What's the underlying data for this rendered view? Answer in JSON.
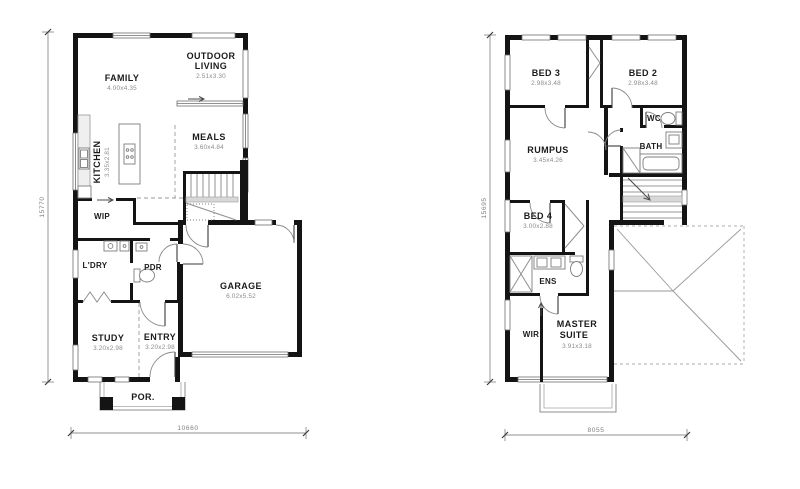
{
  "drawing": {
    "type": "residential floor plans, two storeys",
    "colors": {
      "wall": "#141414",
      "thin_line": "#8f8f8f",
      "room_text": "#1b1b1b",
      "size_text": "#8c8c8c",
      "dim_text": "#7f7f7f",
      "background": "#ffffff"
    }
  },
  "plans": {
    "ground": {
      "title": "ground-floor-plan",
      "dim_height": "15770",
      "dim_width": "10660",
      "rooms": {
        "family": {
          "name": "FAMILY",
          "size": "4.00x4.35"
        },
        "outdoor": {
          "line1": "OUTDOOR",
          "line2": "LIVING",
          "size": "2.51x3.30"
        },
        "kitchen": {
          "name": "KITCHEN",
          "size": "3.35x2.81"
        },
        "meals": {
          "name": "MEALS",
          "size": "3.60x4.84"
        },
        "wip": {
          "name": "WIP"
        },
        "ldry": {
          "name": "L'DRY"
        },
        "pdr": {
          "name": "PDR"
        },
        "study": {
          "name": "STUDY",
          "size": "3.20x2.98"
        },
        "entry": {
          "name": "ENTRY",
          "size": "3.20x2.98"
        },
        "garage": {
          "name": "GARAGE",
          "size": "6.02x5.52"
        },
        "porch": {
          "name": "POR."
        }
      }
    },
    "upper": {
      "title": "upper-floor-plan",
      "dim_height": "15695",
      "dim_width": "8055",
      "rooms": {
        "bed3": {
          "name": "BED 3",
          "size": "2.98x3.48"
        },
        "bed2": {
          "name": "BED 2",
          "size": "2.98x3.48"
        },
        "wc": {
          "name": "WC"
        },
        "bath": {
          "name": "BATH"
        },
        "rumpus": {
          "name": "RUMPUS",
          "size": "3.45x4.26"
        },
        "bed4": {
          "name": "BED 4",
          "size": "3.00x2.88"
        },
        "ens": {
          "name": "ENS"
        },
        "wir": {
          "name": "WIR"
        },
        "master": {
          "line1": "MASTER",
          "line2": "SUITE",
          "size": "3.91x3.18"
        }
      }
    }
  }
}
